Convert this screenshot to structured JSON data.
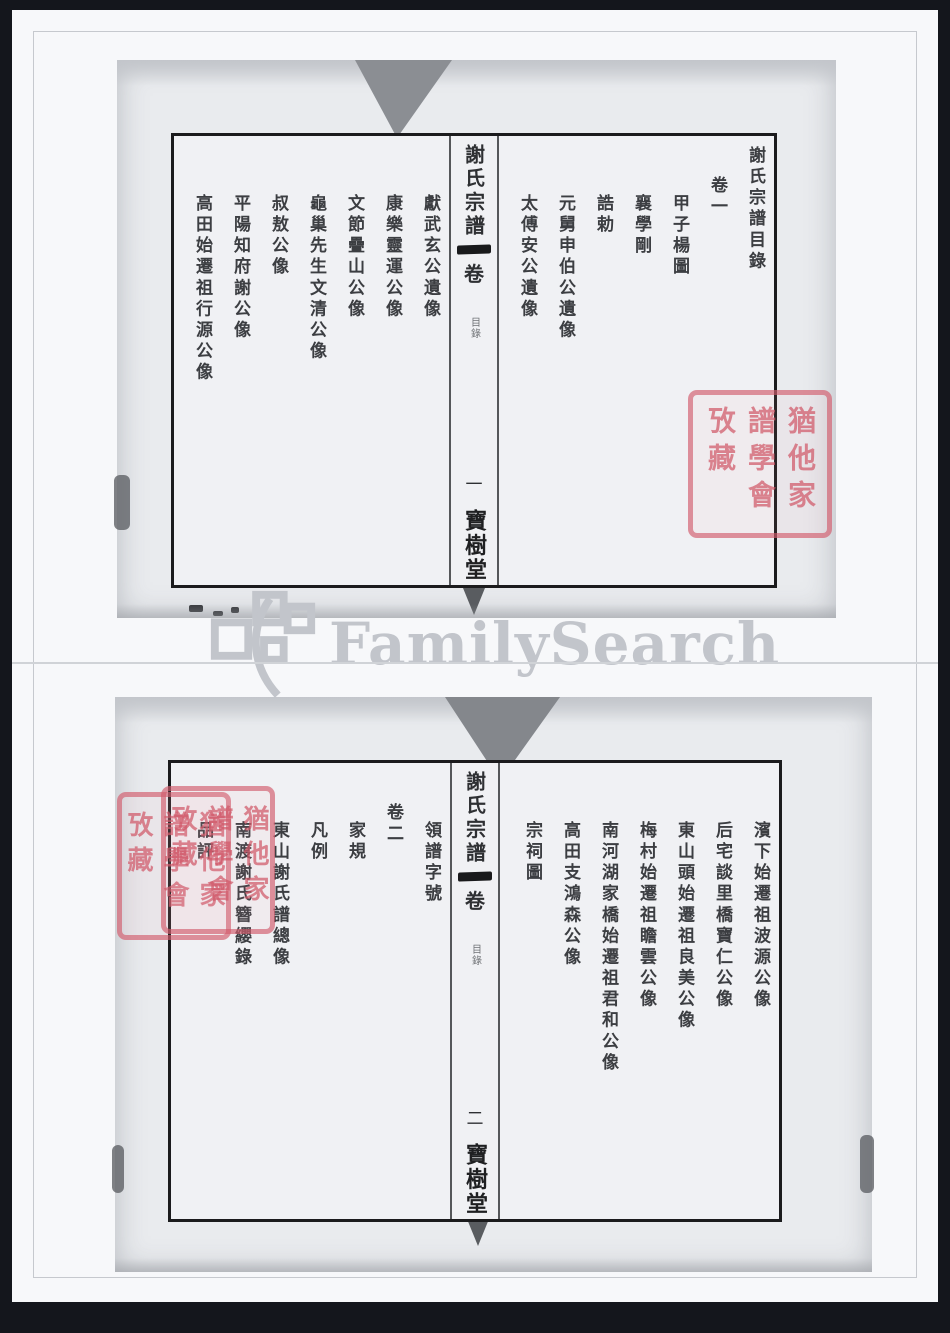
{
  "page": {
    "background_color": "#14161c",
    "sheet_color": "#f7f8fa"
  },
  "watermark": {
    "text": "FamilySearch",
    "color": "#c2c5cb"
  },
  "library_seal": {
    "text": "猶他家譜學會攷藏",
    "color": "#d25c6c"
  },
  "spreads": [
    {
      "name": "volume-1-contents",
      "spine": {
        "title": "謝氏宗譜",
        "volume_char": "卷",
        "section_label": "目錄",
        "page_number": "一",
        "hall_name": "寶樹堂"
      },
      "right_columns": [
        {
          "text": "謝氏宗譜目錄",
          "indent": 0
        },
        {
          "text": "卷一",
          "indent": 1
        },
        {
          "text": "甲子楊圖",
          "indent": 2
        },
        {
          "text": "襄學剛",
          "indent": 2
        },
        {
          "text": "誥勅",
          "indent": 2
        },
        {
          "text": "元舅申伯公遺像",
          "indent": 2
        },
        {
          "text": "太傅安公遺像",
          "indent": 2
        }
      ],
      "left_columns": [
        {
          "text": "獻武玄公遺像",
          "indent": 2
        },
        {
          "text": "康樂靈運公像",
          "indent": 2
        },
        {
          "text": "文節疊山公像",
          "indent": 2
        },
        {
          "text": "龜巢先生文清公像",
          "indent": 2
        },
        {
          "text": "叔敖公像",
          "indent": 2
        },
        {
          "text": "平陽知府謝公像",
          "indent": 2
        },
        {
          "text": "高田始遷祖行源公像",
          "indent": 2
        }
      ]
    },
    {
      "name": "volume-2-contents",
      "spine": {
        "title": "謝氏宗譜",
        "volume_char": "卷",
        "section_label": "目錄",
        "page_number": "二",
        "hall_name": "寶樹堂"
      },
      "right_columns": [
        {
          "text": "濱下始遷祖波源公像",
          "indent": 2
        },
        {
          "text": "后宅談里橋寶仁公像",
          "indent": 2
        },
        {
          "text": "東山頭始遷祖良美公像",
          "indent": 2
        },
        {
          "text": "梅村始遷祖瞻雲公像",
          "indent": 2
        },
        {
          "text": "南河湖家橋始遷祖君和公像",
          "indent": 2
        },
        {
          "text": "高田支鴻森公像",
          "indent": 2
        },
        {
          "text": "宗祠圖",
          "indent": 2
        }
      ],
      "left_columns": [
        {
          "text": "領譜字號",
          "indent": 2
        },
        {
          "text": "卷二",
          "indent": 1
        },
        {
          "text": "家規",
          "indent": 2
        },
        {
          "text": "凡例",
          "indent": 2
        },
        {
          "text": "東山謝氏譜總像",
          "indent": 2
        },
        {
          "text": "南渡謝氏簪纓錄",
          "indent": 2
        },
        {
          "text": "品評",
          "indent": 2
        }
      ]
    }
  ]
}
